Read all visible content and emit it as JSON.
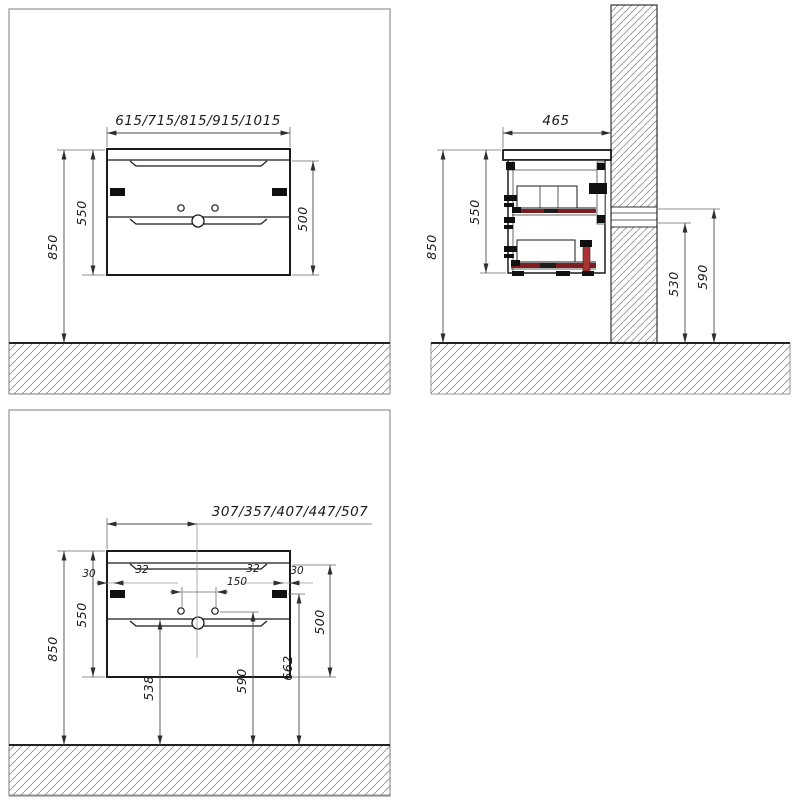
{
  "drawing": {
    "type": "technical-dimension-drawing",
    "subject": "wall-hung vanity cabinet with two drawers",
    "units": "mm",
    "line_color": "#1a1a1a",
    "accent_red": "#7d1d1d",
    "front_view": {
      "width_variants": "615/715/815/915/1015",
      "total_height": "550",
      "body_height": "500",
      "mounting_height": "850"
    },
    "side_view": {
      "depth": "465",
      "total_height": "550",
      "mounting_height": "850",
      "connection_low": "530",
      "connection_high": "590"
    },
    "detail_view": {
      "center_variants": "307/357/407/447/507",
      "edge_gap_left": "30",
      "handle_gap_left": "32",
      "faucet_holes_spacing": "150",
      "handle_gap_right": "32",
      "edge_gap_right": "30",
      "total_height": "550",
      "body_height": "500",
      "mounting_height": "850",
      "siphon_height": "538",
      "faucet_holes_height": "590",
      "handles_height": "662"
    }
  }
}
